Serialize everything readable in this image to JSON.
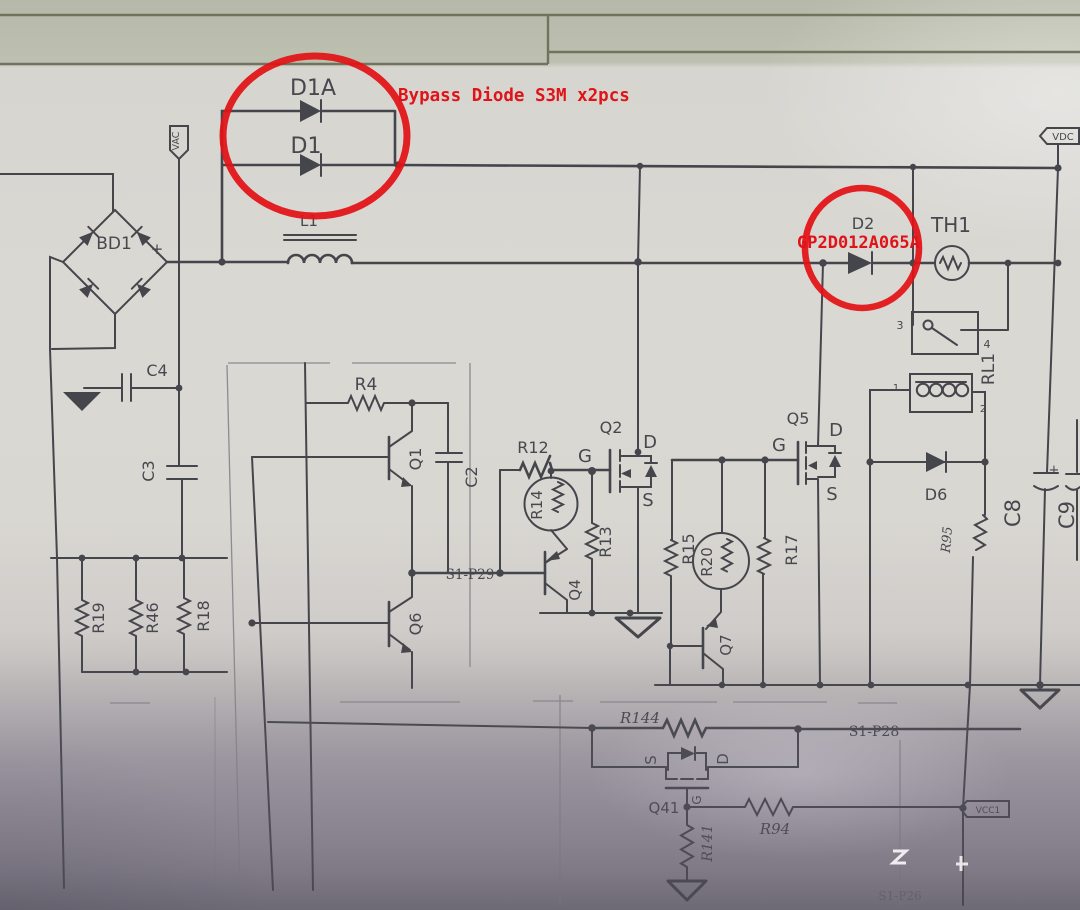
{
  "annotations": {
    "bypass_note": "Bypass Diode S3M x2pcs",
    "d2_part": "GP2D012A065A"
  },
  "flags": {
    "vac": "VAC",
    "vdc": "VDC",
    "vcc1": "VCC1"
  },
  "nets": {
    "s1p29": "S1-P29",
    "s1p28": "S1-P28",
    "s1p26": "S1-P26"
  },
  "components": {
    "d1a": "D1A",
    "d1": "D1",
    "l1": "L1",
    "bd1": "BD1",
    "c4": "C4",
    "c3": "C3",
    "c2": "C2",
    "r4": "R4",
    "q1": "Q1",
    "q6": "Q6",
    "r19": "R19",
    "r46": "R46",
    "r18": "R18",
    "r12": "R12",
    "r14": "R14",
    "r13": "R13",
    "q2": "Q2",
    "q4": "Q4",
    "q5": "Q5",
    "r15": "R15",
    "r20": "R20",
    "r17": "R17",
    "q7": "Q7",
    "d2": "D2",
    "th1": "TH1",
    "rl1": "RL1",
    "d6": "D6",
    "r95": "R95",
    "c8": "C8",
    "c9": "C9",
    "r144": "R144",
    "q41": "Q41",
    "r141": "R141",
    "r94": "R94"
  },
  "pins": {
    "g": "G",
    "d": "D",
    "s": "S",
    "p1": "1",
    "p2": "2",
    "p3": "3",
    "p4": "4",
    "plus": "+"
  },
  "colors": {
    "annotation_red": "#e01418",
    "ink": "#45454c"
  }
}
